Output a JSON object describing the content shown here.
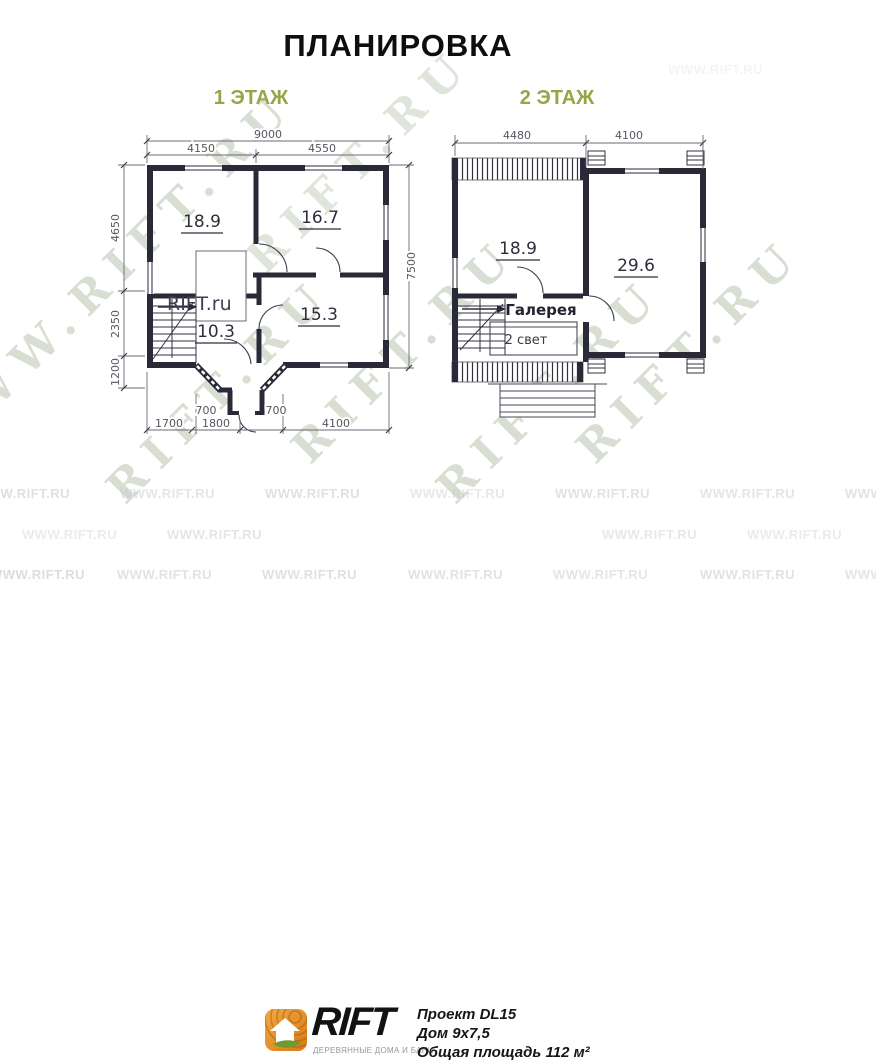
{
  "title": "ПЛАНИРОВКА",
  "floors": {
    "floor1": {
      "label": "1 ЭТАЖ",
      "rooms": {
        "r1": "18.9",
        "r2": "16.7",
        "r3": "10.3",
        "r4": "15.3"
      },
      "inner_brand": "RIFT.ru",
      "dims": {
        "total_width": "9000",
        "width_left": "4150",
        "width_right": "4550",
        "left_upper": "4650",
        "left_mid": "2350",
        "left_lower": "1200",
        "total_height": "7500",
        "bottom_1": "1700",
        "bottom_2": "1800",
        "bottom_3": "4100",
        "bay_left": "700",
        "bay_right": "700"
      }
    },
    "floor2": {
      "label": "2 ЭТАЖ",
      "rooms": {
        "r1": "18.9",
        "r2": "29.6"
      },
      "gallery": "Галерея",
      "double_light": "2 свет",
      "dims": {
        "width_left": "4480",
        "width_right": "4100"
      }
    }
  },
  "watermark": {
    "diagonal": "RIFT.RU",
    "diagonal_www": "WWW.RIFT.RU",
    "row": "WWW.RIFT.RU"
  },
  "footer": {
    "brand": "RIFT",
    "tagline": "ДЕРЕВЯННЫЕ ДОМА И БАНИ",
    "project": "Проект DL15",
    "house": "Дом 9х7,5",
    "area": "Общая площадь 112 м²"
  },
  "colors": {
    "wall": "#292938",
    "green": "#94a647",
    "orange": "#e5891f",
    "watermark": "#c8d0c2"
  }
}
